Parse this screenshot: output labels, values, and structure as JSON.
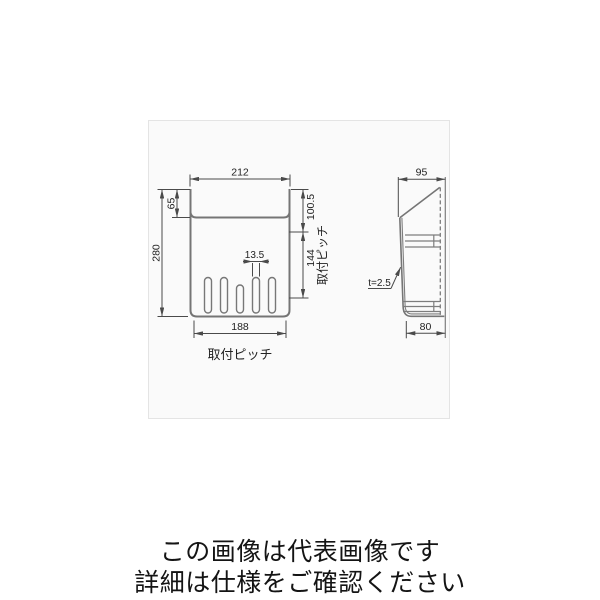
{
  "drawing": {
    "colors": {
      "panel_background": "#fafafa",
      "panel_border": "#e4e4e4",
      "outline_gray": "#757575",
      "dimension_line": "#4a4a4a",
      "text": "#222222"
    },
    "views": {
      "front": {
        "dimensions": {
          "top_width": "212",
          "flange_height": "65",
          "total_height": "280",
          "right_upper": "100.5",
          "right_pitch": "144",
          "slot_width": "13.5",
          "bottom_pitch": "188"
        },
        "labels": {
          "right_pitch_label": "取付ピッチ",
          "bottom_pitch_label": "取付ピッチ"
        },
        "slot_count": 5
      },
      "side": {
        "dimensions": {
          "top_depth": "95",
          "bottom_depth": "80"
        },
        "labels": {
          "thickness": "t=2.5"
        }
      }
    }
  },
  "caption": {
    "line1": "この画像は代表画像です",
    "line2": "詳細は仕様をご確認ください"
  }
}
